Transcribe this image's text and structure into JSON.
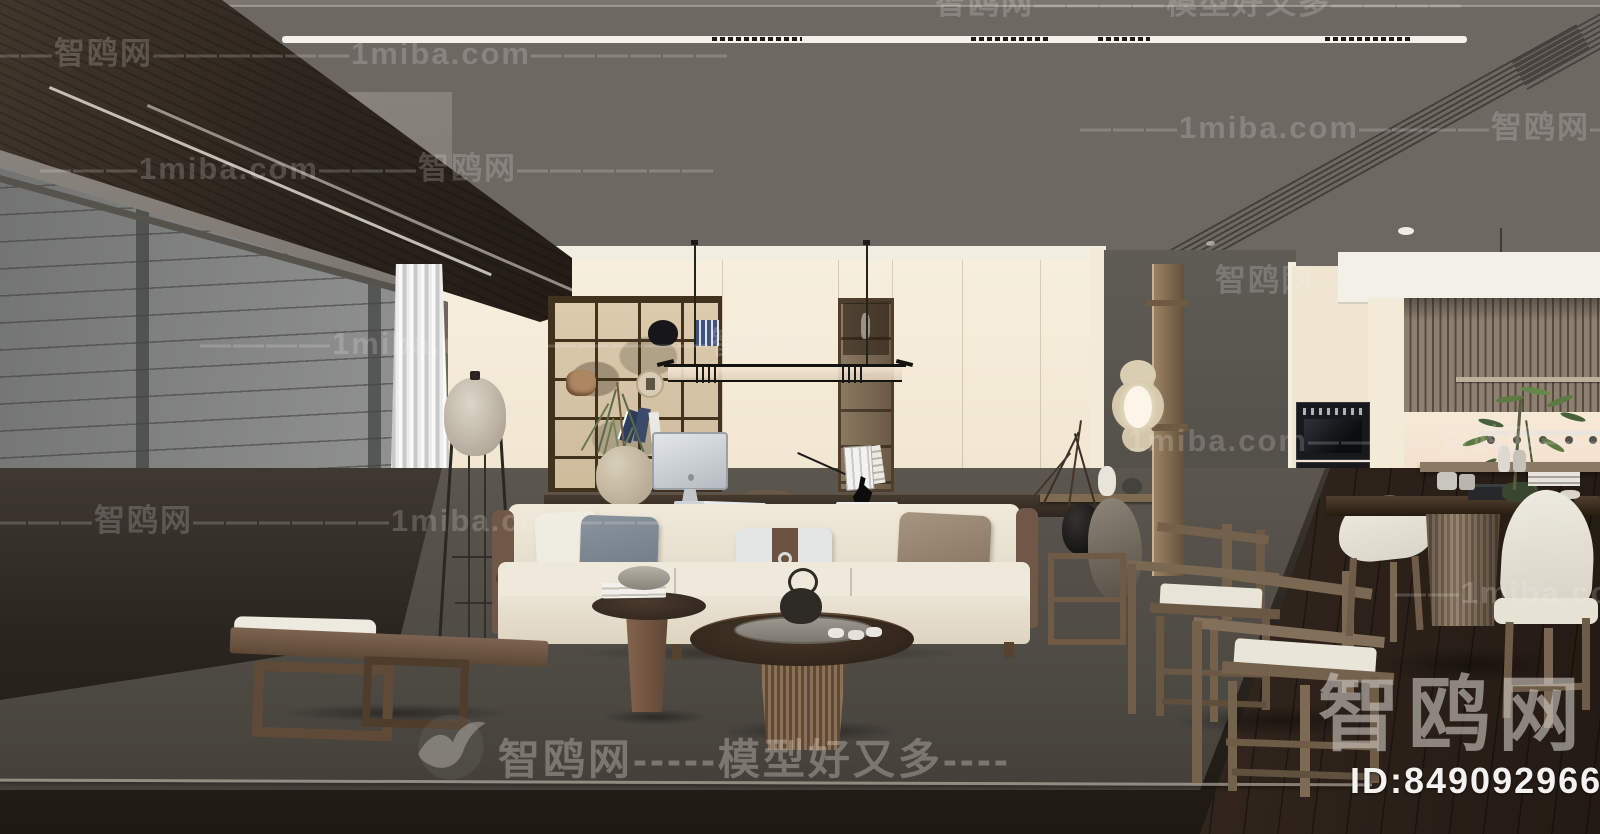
{
  "watermarks": {
    "site_cn": "智鸥网",
    "site_en": "1miba.com",
    "slogan": "模型好又多",
    "rows": [
      {
        "x": 935,
        "y": -22,
        "text": "智鸥网————模型好又多————"
      },
      {
        "x": -45,
        "y": 28,
        "text": "———智鸥网——————1miba.com——————"
      },
      {
        "x": 1080,
        "y": 102,
        "text": "———1miba.com————智鸥网—"
      },
      {
        "x": 40,
        "y": 143,
        "text": "———1miba.com———智鸥网——————"
      },
      {
        "x": 1215,
        "y": 255,
        "text": "智鸥网——————1mi"
      },
      {
        "x": 200,
        "y": 318,
        "text": "————1miba.com——————智鸥网"
      },
      {
        "x": 1128,
        "y": 415,
        "text": "1miba.com————智鸥网——"
      },
      {
        "x": -5,
        "y": 495,
        "text": "———智鸥网——————1miba.com———"
      },
      {
        "x": 1395,
        "y": 575,
        "text": "——1miba.com"
      }
    ],
    "center_text": "智鸥网-----模型好又多----"
  },
  "footer": {
    "logo": "智鸥网",
    "id": "ID:849092966"
  },
  "colors": {
    "ceiling": "#6d6862",
    "beam_wood": "#362c23",
    "cream_wall": "#f4ebd9",
    "gray_partition": "#5c5851",
    "rug": "#57534d",
    "dark_floor": "#241d16",
    "sofa": "#ece5d5",
    "chair_wood": "#74624d",
    "appliance_black": "#17191c"
  }
}
